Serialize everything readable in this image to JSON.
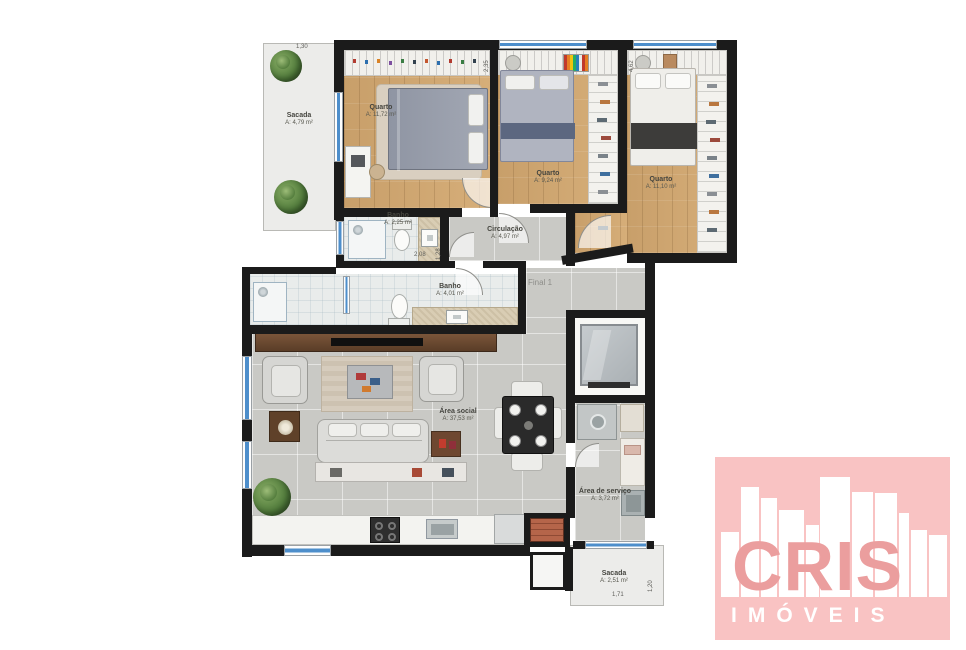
{
  "floorplan": {
    "unit_label": "Final 1",
    "rooms": {
      "sacada_top": {
        "name": "Sacada",
        "area": "A: 4,79 m²"
      },
      "quarto1": {
        "name": "Quarto",
        "area": "A: 11,72 m²"
      },
      "quarto2": {
        "name": "Quarto",
        "area": "A: 9,24 m²"
      },
      "quarto3": {
        "name": "Quarto",
        "area": "A: 11,10 m²"
      },
      "banho1": {
        "name": "Banho",
        "area": "A: 2,25 m²"
      },
      "banho2": {
        "name": "Banho",
        "area": "A: 4,01 m²"
      },
      "circulacao": {
        "name": "Circulação",
        "area": "A: 4,97 m²"
      },
      "area_social": {
        "name": "Área social",
        "area": "A: 37,53 m²"
      },
      "area_servico": {
        "name": "Área de serviço",
        "area": "A: 3,72 m²"
      },
      "sacada_bottom": {
        "name": "Sacada",
        "area": "A: 2,51 m²"
      }
    },
    "dimensions": {
      "d1": "1,30",
      "d2": "2,35",
      "d3": "4,62",
      "d4": "2,08",
      "d5": "1,28",
      "d6": "1,71",
      "d7": "1,20"
    }
  },
  "branding": {
    "logo_text": "CRIS",
    "logo_subtext": "IMÓVEIS",
    "colors": {
      "background": "#f9c3c3",
      "wordmark": "#eb9e9e",
      "buildings": "#ffffff"
    }
  },
  "palette": {
    "wall": "#1b1b1b",
    "window_glass": "#4d8ecb",
    "wood_floor": "#cda671",
    "gray_floor": "#c9c9c5"
  }
}
